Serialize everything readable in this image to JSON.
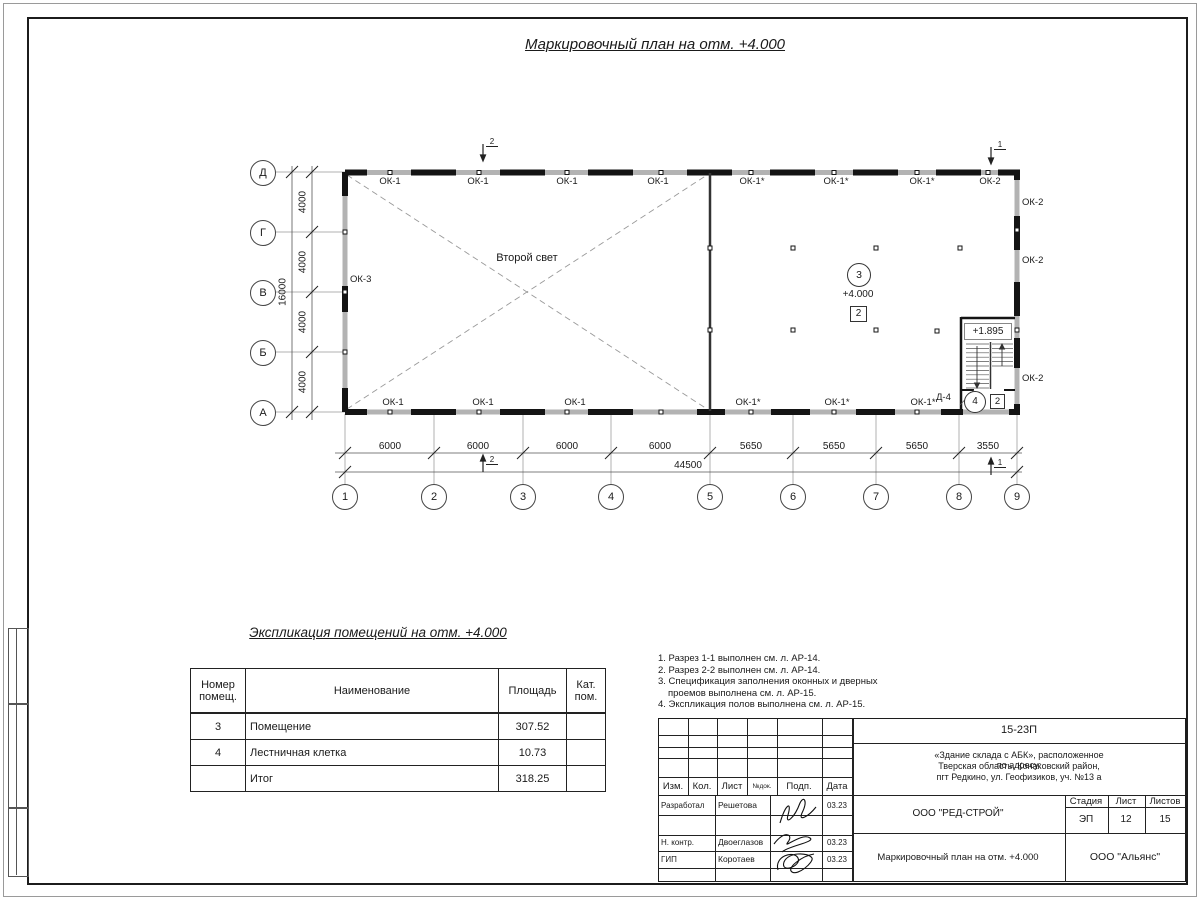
{
  "sheet": {
    "main_title": "Маркировочный план на отм. +4.000",
    "section_marker_1": "1",
    "section_marker_2": "2"
  },
  "plan": {
    "second_light_label": "Второй свет",
    "room3": {
      "number": "3",
      "elevation": "+4.000",
      "zone": "2"
    },
    "stair": {
      "elevation": "+1.895",
      "door_label": "Д-4",
      "number": "4",
      "zone": "2"
    },
    "axes_rows": [
      "Д",
      "Г",
      "В",
      "Б",
      "А"
    ],
    "axes_cols": [
      "1",
      "2",
      "3",
      "4",
      "5",
      "6",
      "7",
      "8",
      "9"
    ],
    "dims_vertical": [
      "4000",
      "4000",
      "4000",
      "4000"
    ],
    "dim_vertical_total": "16000",
    "dims_horizontal": [
      "6000",
      "6000",
      "6000",
      "6000",
      "5650",
      "5650",
      "5650",
      "3550"
    ],
    "dim_horizontal_total": "44500",
    "top_window_labels": [
      "ОК-1",
      "ОК-1",
      "ОК-1",
      "ОК-1",
      "ОК-1*",
      "ОК-1*",
      "ОК-1*",
      "ОК-2"
    ],
    "bottom_window_labels": [
      "ОК-1",
      "ОК-1",
      "ОК-1",
      "ОК-1*",
      "ОК-1*",
      "ОК-1*"
    ],
    "right_window_labels": [
      "ОК-2",
      "ОК-2",
      "ОК-2"
    ],
    "left_window_label": "ОК-3"
  },
  "explication": {
    "title": "Экспликация помещений на отм. +4.000",
    "headers": {
      "c1l1": "Номер",
      "c1l2": "помещ.",
      "c2": "Наименование",
      "c3": "Площадь",
      "c4l1": "Кат.",
      "c4l2": "пом."
    },
    "rows": [
      [
        "3",
        "Помещение",
        "307.52",
        ""
      ],
      [
        "4",
        "Лестничная клетка",
        "10.73",
        ""
      ],
      [
        "",
        "Итог",
        "318.25",
        ""
      ]
    ]
  },
  "notes": [
    "1. Разрез 1-1 выполнен см. л. АР-14.",
    "2. Разрез 2-2 выполнен см. л. АР-14.",
    "3. Спецификация заполнения оконных и дверных",
    "проемов выполнена см. л. АР-15.",
    "4. Экспликация полов выполнена см. л. АР-15."
  ],
  "title_block": {
    "doc_number": "15-23П",
    "object_line1": "«Здание склада с АБК», расположенное по адресу:",
    "object_line2": "Тверская область, Конаковский район,",
    "object_line3": "пгт Редкино, ул. Геофизиков, уч. №13 а",
    "col_izm": "Изм.",
    "col_kol": "Кол.",
    "col_list": "Лист",
    "col_doc": "№док.",
    "col_podp": "Подп.",
    "col_data": "Дата",
    "role1": "Разработал",
    "name1": "Решетова",
    "date1": "03.23",
    "role2": "Н. контр.",
    "name2": "Двоеглазов",
    "date2": "03.23",
    "role3": "ГИП",
    "name3": "Коротаев",
    "date3": "03.23",
    "company": "ООО \"РЕД-СТРОЙ\"",
    "sheet_title": "Маркировочный план на отм. +4.000",
    "stage_label": "Стадия",
    "sheet_label": "Лист",
    "sheets_label": "Листов",
    "stage": "ЭП",
    "sheet_no": "12",
    "sheets_total": "15",
    "contractor": "ООО \"Альянс\""
  },
  "colors": {
    "wall_gray": "#b3b3b3",
    "line_dark": "#141414"
  }
}
